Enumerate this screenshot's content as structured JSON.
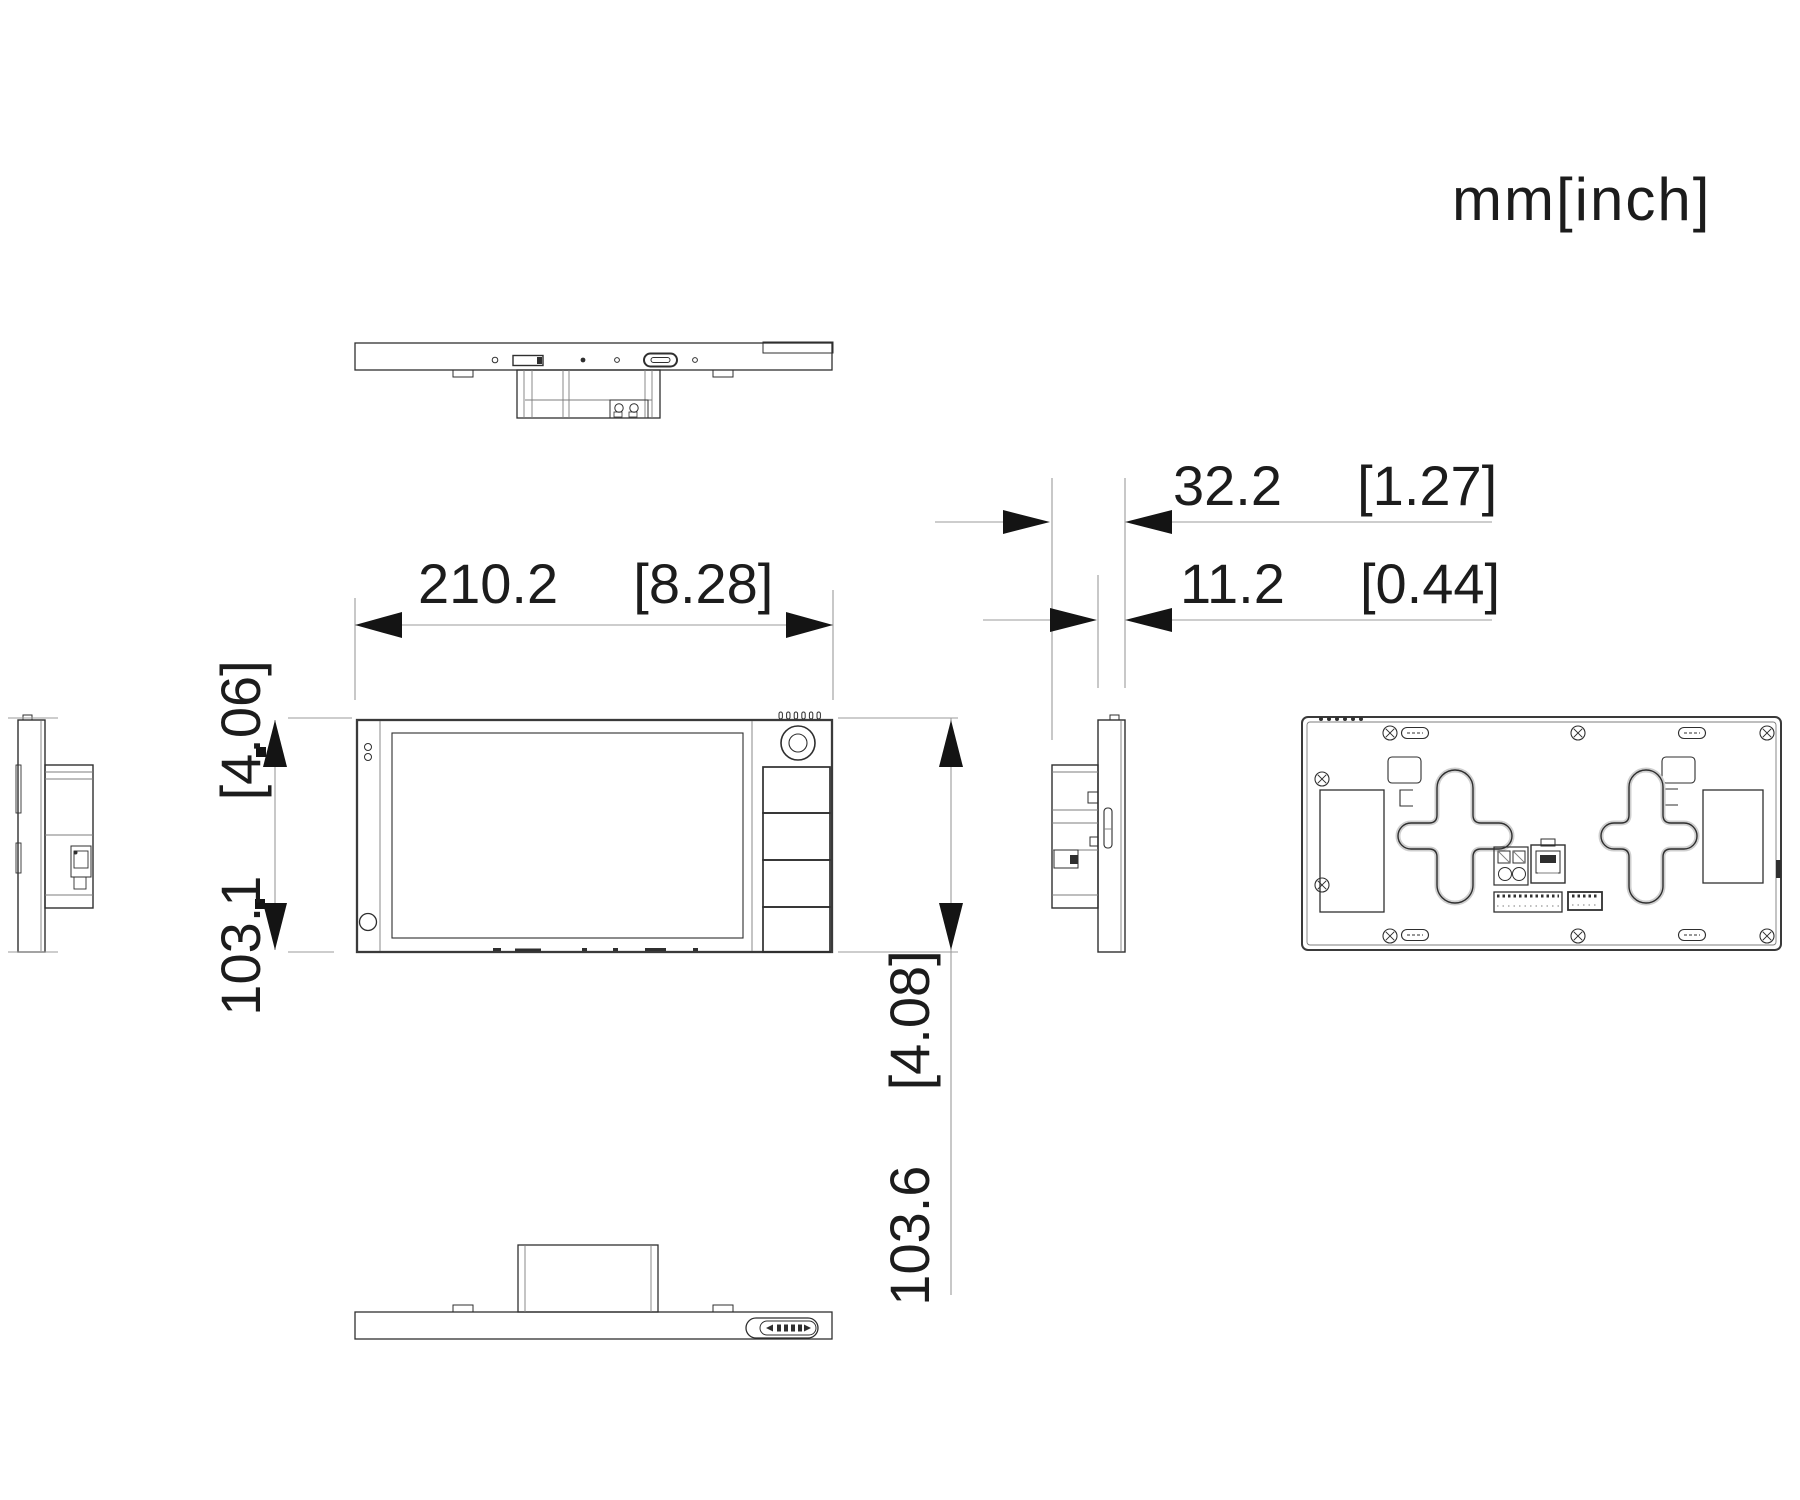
{
  "units_label": "mm[inch]",
  "dimensions": {
    "front_width": "210.2  [8.28]",
    "front_height": "103.1  [4.06]",
    "mount_depth": "32.2  [1.27]",
    "panel_depth": "11.2  [0.44]",
    "overall_height": "103.6  [4.08]"
  },
  "colors": {
    "background": "#ffffff",
    "outline": "#2f2f2f",
    "dimension_line": "#9b9b9b",
    "arrow": "#141414",
    "text": "#1c1c1c"
  }
}
